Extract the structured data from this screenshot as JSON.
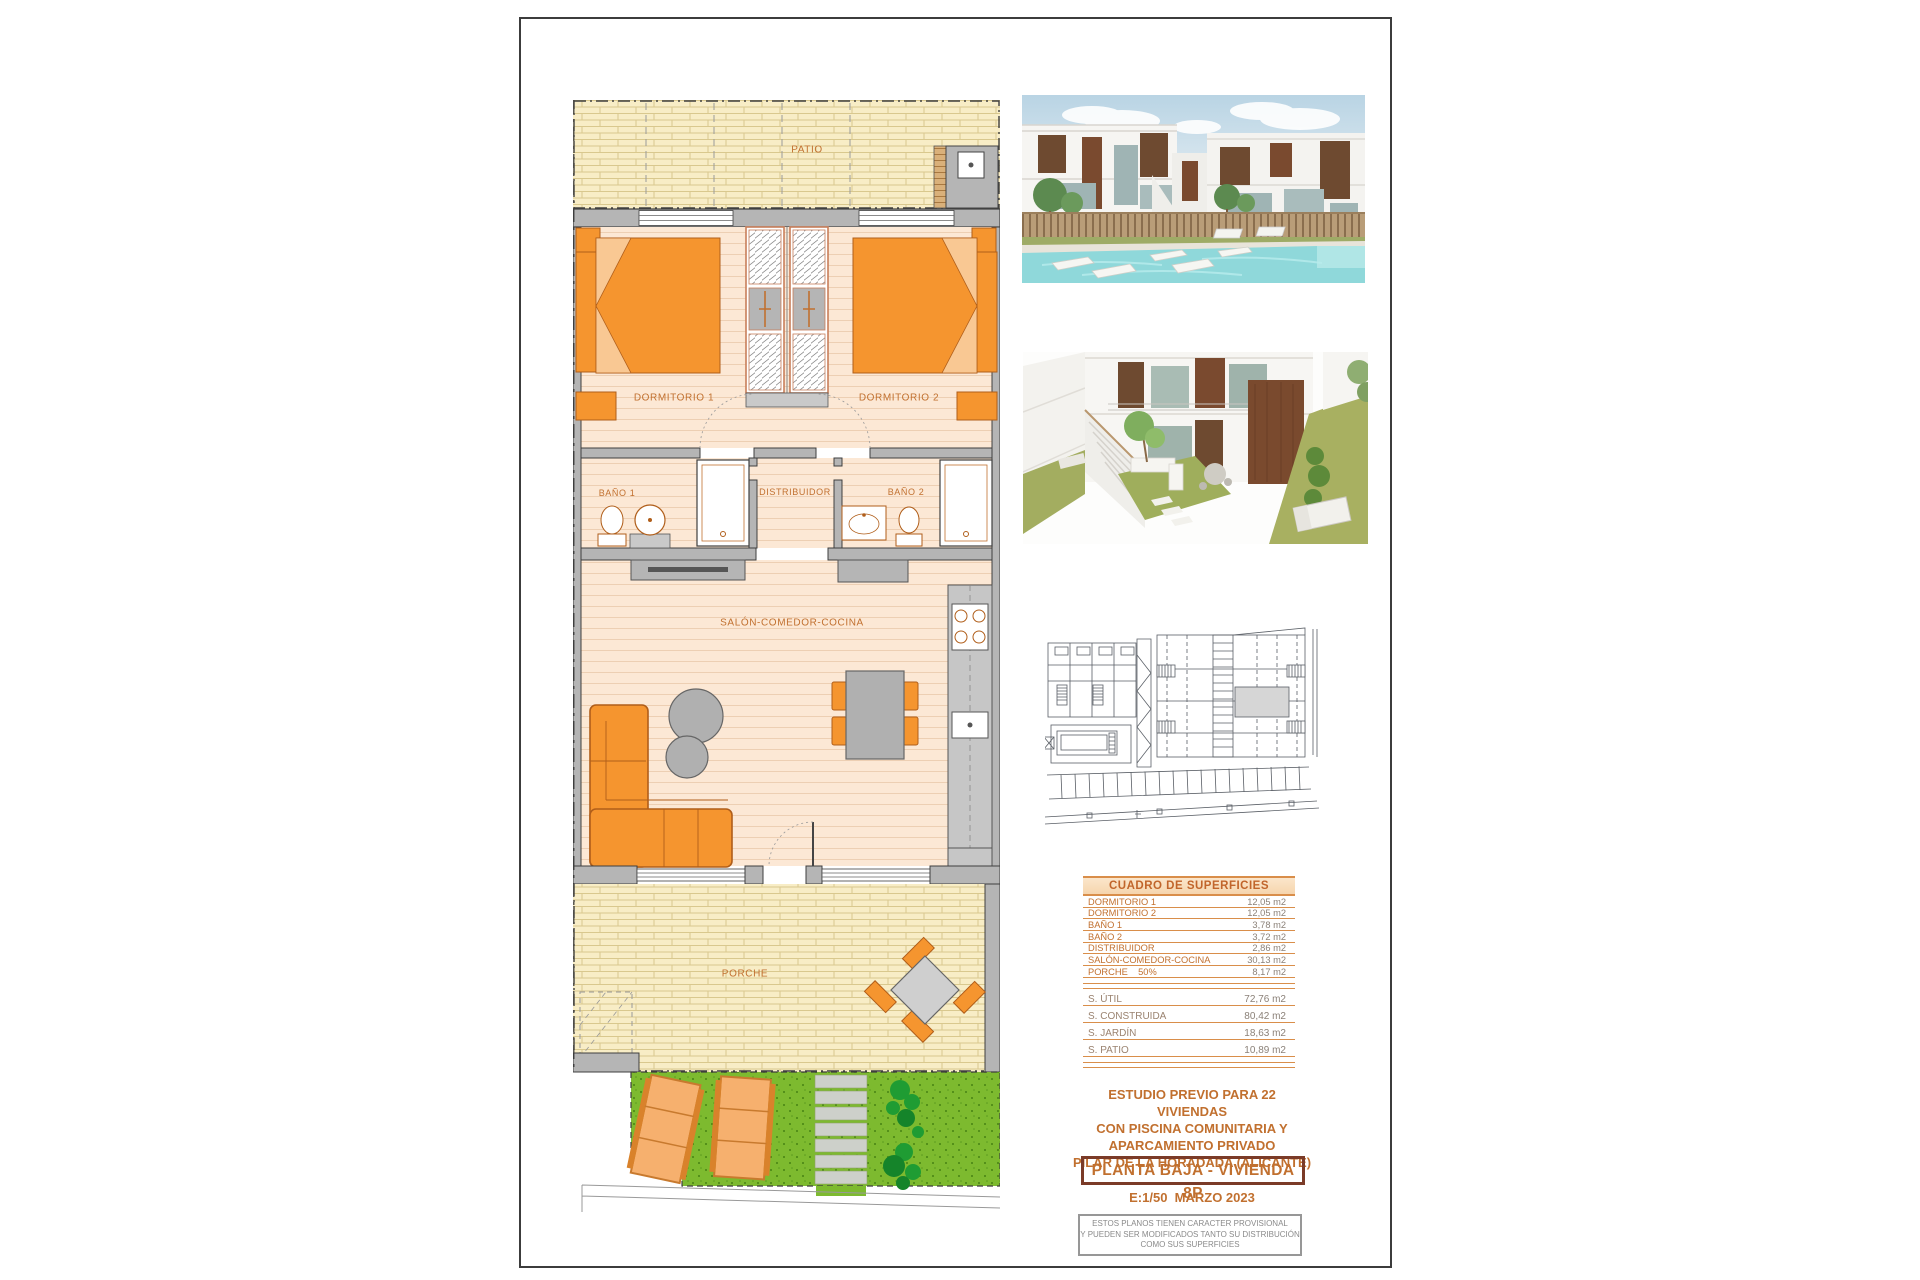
{
  "plan": {
    "rooms": {
      "patio": "PATIO",
      "dormitorio1": "DORMITORIO 1",
      "dormitorio2": "DORMITORIO 2",
      "bano1": "BAÑO 1",
      "distribuidor": "DISTRIBUIDOR",
      "bano2": "BAÑO 2",
      "salon": "SALÓN-COMEDOR-COCINA",
      "porche": "PORCHE"
    }
  },
  "areas_table": {
    "title": "CUADRO DE SUPERFICIES",
    "rows": [
      {
        "label": "DORMITORIO 1",
        "value": "12,05 m2"
      },
      {
        "label": "DORMITORIO 2",
        "value": "12,05 m2"
      },
      {
        "label": "BAÑO 1",
        "value": "3,78 m2"
      },
      {
        "label": "BAÑO 2",
        "value": "3,72 m2"
      },
      {
        "label": "DISTRIBUIDOR",
        "value": "2,86 m2"
      },
      {
        "label": "SALÓN-COMEDOR-COCINA",
        "value": "30,13 m2"
      },
      {
        "label": "PORCHE    50%",
        "value": "8,17 m2"
      }
    ],
    "totals": [
      {
        "label": "S. ÚTIL",
        "value": "72,76 m2"
      },
      {
        "label": "S. CONSTRUIDA",
        "value": "80,42 m2"
      },
      {
        "label": "S. JARDÍN",
        "value": "18,63 m2"
      },
      {
        "label": "S. PATIO",
        "value": "10,89 m2"
      }
    ]
  },
  "title_block": {
    "line1": "ESTUDIO PREVIO PARA 22 VIVIENDAS",
    "line2": "CON PISCINA COMUNITARIA Y",
    "line3": "APARCAMIENTO PRIVADO",
    "line4": "PILAR DE LA HORADADA (ALICANTE)",
    "plan_name": "PLANTA BAJA - VIVIENDA 8P",
    "scale_date": "E:1/50  MARZO 2023"
  },
  "disclaimer": {
    "line1": "ESTOS PLANOS TIENEN CARACTER PROVISIONAL",
    "line2": "Y PUEDEN SER MODIFICADOS TANTO SU DISTRIBUCIÓN",
    "line3": "COMO SUS SUPERFICIES"
  },
  "colors": {
    "accent_orange": "#c1702f",
    "furniture_orange": "#f5952f",
    "floor_peach": "#fce8d5",
    "paving_beige": "#f8edc6",
    "wall_gray": "#b5b5b5",
    "garden_green": "#7dba2f",
    "table_line_orange": "#d98e4a",
    "box_border_brown": "#7b3b28"
  }
}
